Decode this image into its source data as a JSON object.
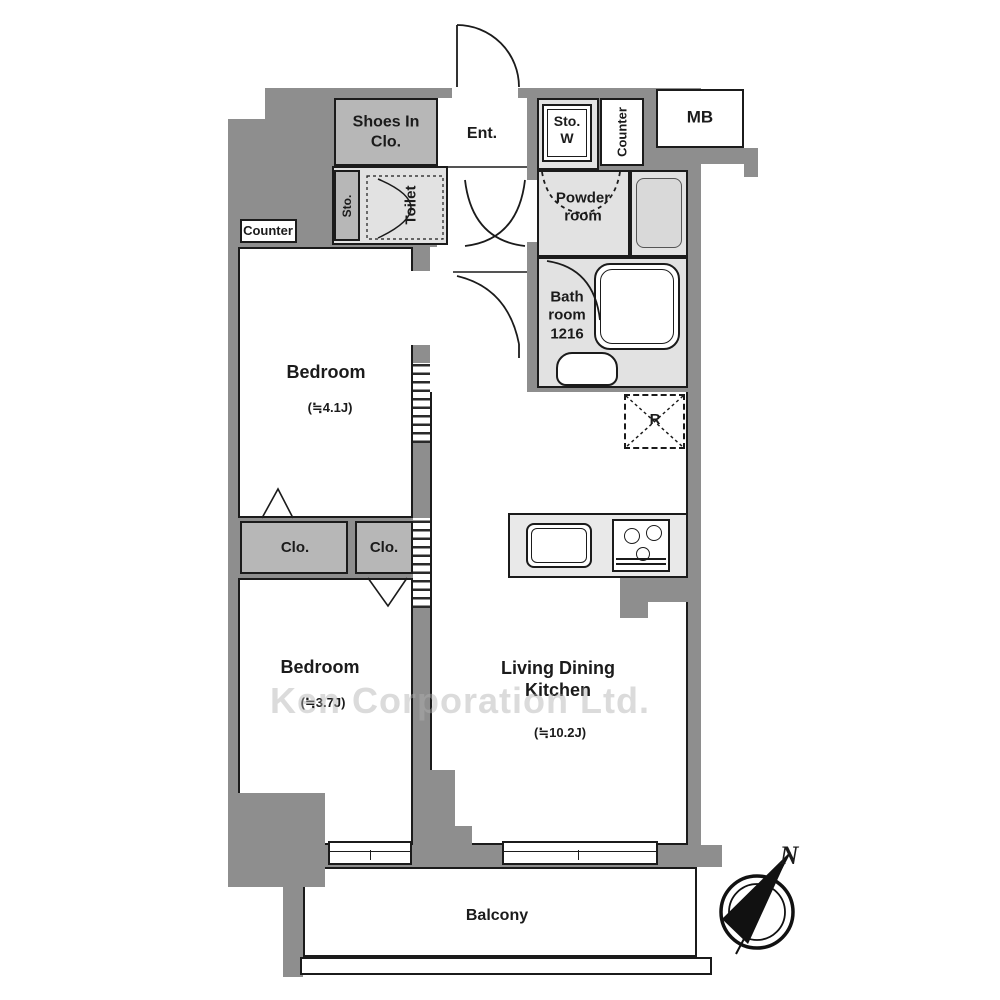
{
  "watermark": "Ken Corporation Ltd.",
  "compass": {
    "north_label": "N"
  },
  "colors": {
    "wall": "#8e8e8e",
    "wet_room": "#e2e2e2",
    "closet": "#b7b7b7",
    "counter": "#e9e9e9",
    "line": "#1b1b1b"
  },
  "rooms": {
    "shoes_in_closet": {
      "label": "Shoes In Clo."
    },
    "entrance": {
      "label": "Ent."
    },
    "storage_washer": {
      "label": "Sto. W"
    },
    "counter_top": {
      "label": "Counter"
    },
    "meter_box": {
      "label": "MB"
    },
    "toilet": {
      "label": "Toilet"
    },
    "toilet_storage": {
      "label": "Sto."
    },
    "powder_room": {
      "label": "Powder room"
    },
    "bathroom": {
      "label": "Bath room",
      "size": "1216"
    },
    "counter_left": {
      "label": "Counter"
    },
    "refrigerator_space": {
      "label": "R"
    },
    "closet_1": {
      "label": "Clo."
    },
    "closet_2": {
      "label": "Clo."
    },
    "bedroom_1": {
      "label": "Bedroom",
      "area": "(≒4.1J)"
    },
    "bedroom_2": {
      "label": "Bedroom",
      "area": "(≒3.7J)"
    },
    "living_dining_kitchen": {
      "label": "Living Dining Kitchen",
      "area": "(≒10.2J)"
    },
    "balcony": {
      "label": "Balcony"
    }
  }
}
